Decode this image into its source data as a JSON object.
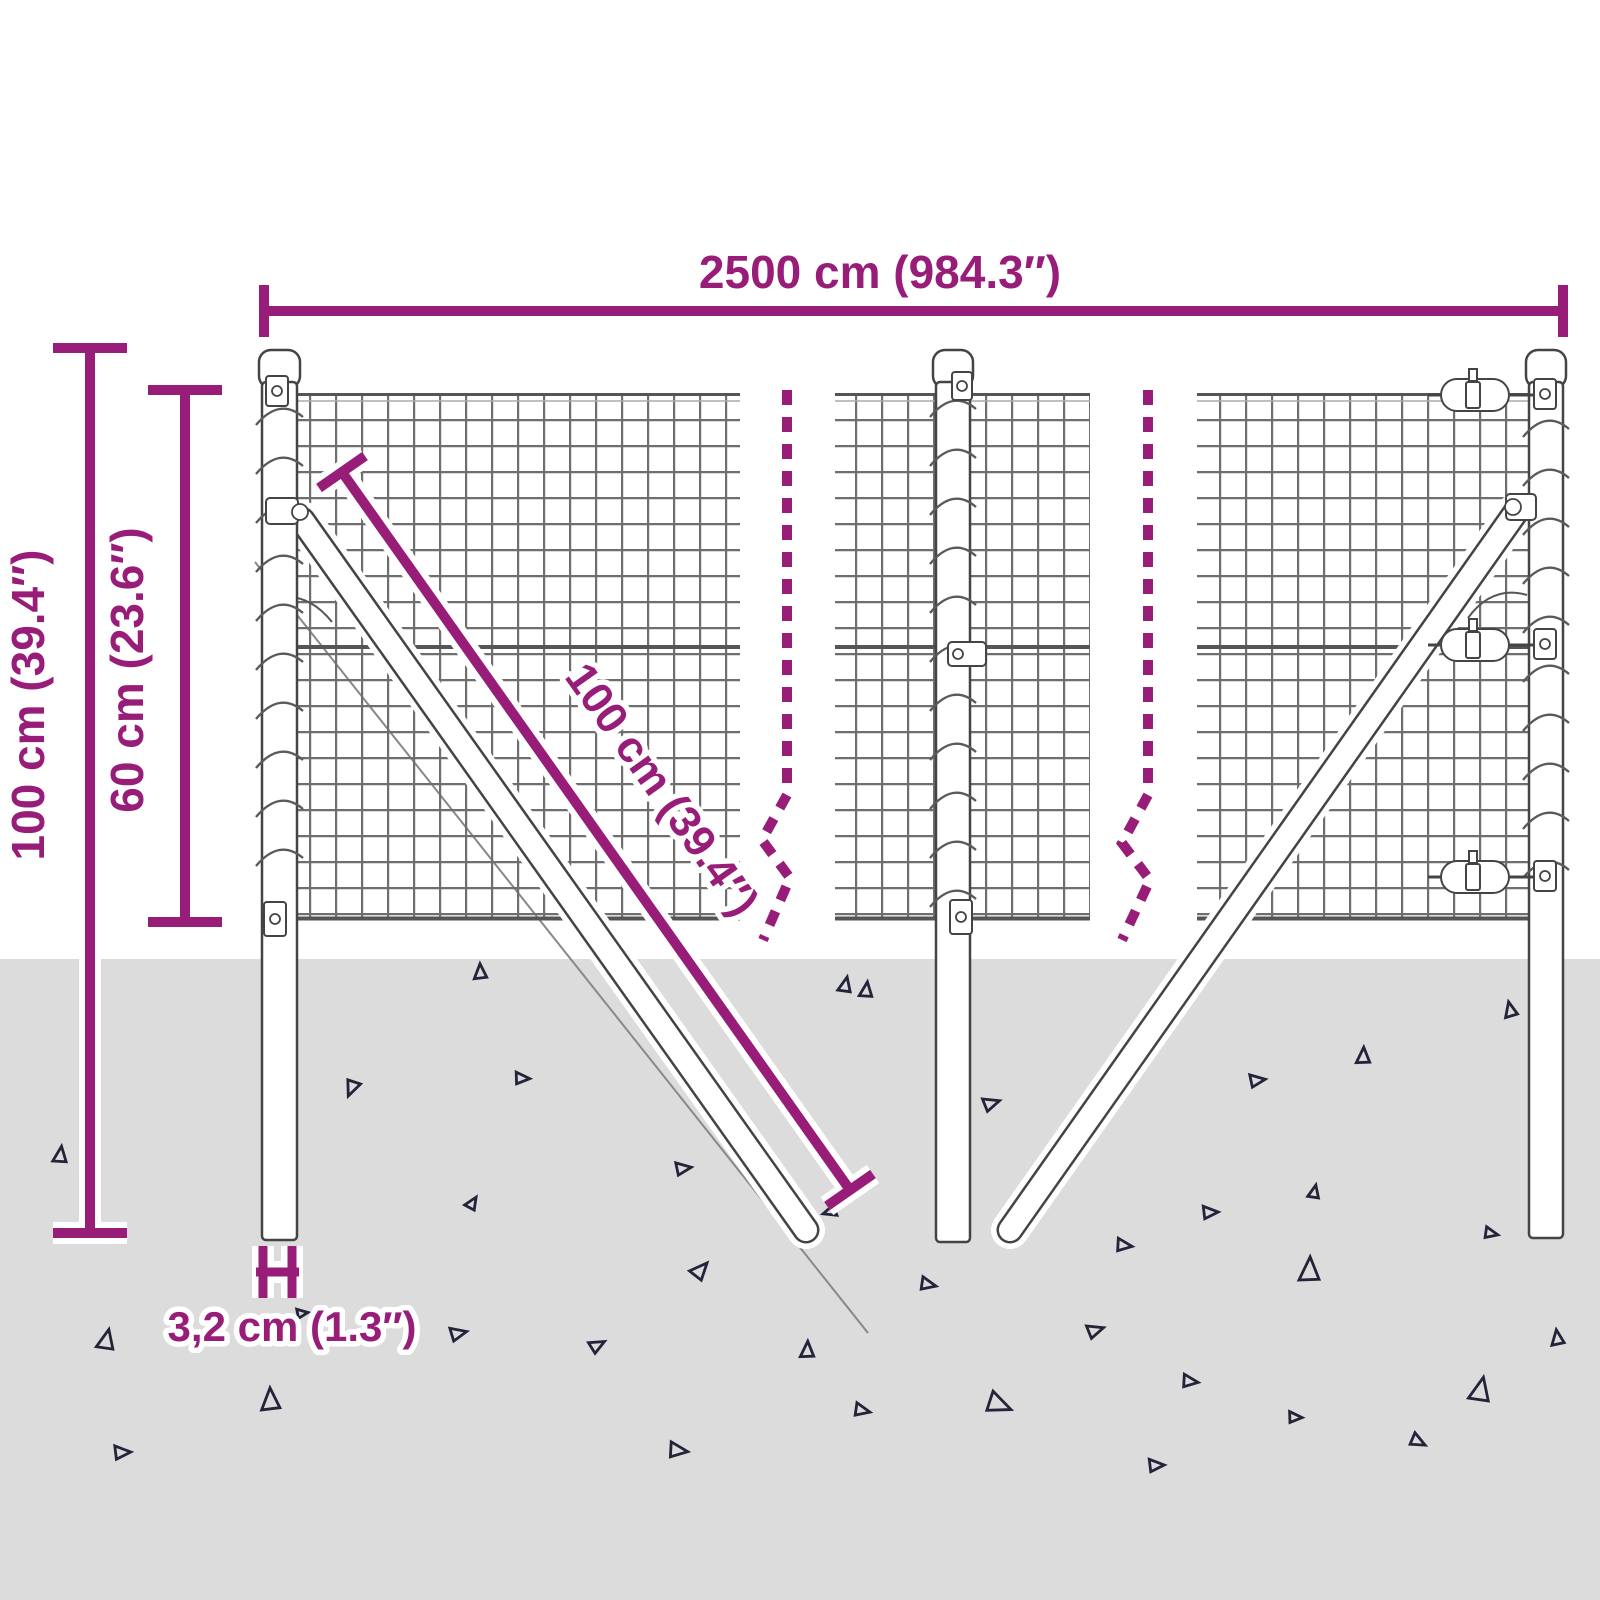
{
  "diagram": {
    "name": "wire-mesh-fence-dimension-diagram"
  },
  "labels": {
    "total_width": "2500 cm (984.3″)",
    "post_height": "100 cm (39.4″)",
    "mesh_height": "60 cm (23.6″)",
    "brace_length": "100 cm (39.4″)",
    "post_diameter": "3,2 cm (1.3″)"
  },
  "colors": {
    "accent": "#981d78",
    "ground": "#dcdcdc",
    "mesh_line": "#6e6e6e",
    "outline": "#444444",
    "triangle": "#23233a",
    "wire": "#555555"
  },
  "ground": {
    "triangles": [
      {
        "x": 480,
        "y": 972,
        "s": 15,
        "r": 0
      },
      {
        "x": 845,
        "y": 985,
        "s": 15,
        "r": 15
      },
      {
        "x": 352,
        "y": 1088,
        "s": 16,
        "r": 205
      },
      {
        "x": 522,
        "y": 1078,
        "s": 14,
        "r": 95
      },
      {
        "x": 60,
        "y": 1155,
        "s": 16,
        "r": 10
      },
      {
        "x": 683,
        "y": 1168,
        "s": 15,
        "r": 85
      },
      {
        "x": 472,
        "y": 1203,
        "s": 13,
        "r": 35
      },
      {
        "x": 700,
        "y": 1270,
        "s": 18,
        "r": 45
      },
      {
        "x": 991,
        "y": 1103,
        "s": 16,
        "r": 75
      },
      {
        "x": 1363,
        "y": 1056,
        "s": 16,
        "r": 5
      },
      {
        "x": 1257,
        "y": 1080,
        "s": 15,
        "r": 85
      },
      {
        "x": 1510,
        "y": 1010,
        "s": 15,
        "r": 350
      },
      {
        "x": 866,
        "y": 990,
        "s": 15,
        "r": 10
      },
      {
        "x": 1314,
        "y": 1192,
        "s": 13,
        "r": 15
      },
      {
        "x": 1210,
        "y": 1212,
        "s": 15,
        "r": 90
      },
      {
        "x": 1491,
        "y": 1233,
        "s": 13,
        "r": 105
      },
      {
        "x": 1124,
        "y": 1245,
        "s": 15,
        "r": 100
      },
      {
        "x": 1309,
        "y": 1270,
        "s": 24,
        "r": 5
      },
      {
        "x": 928,
        "y": 1284,
        "s": 15,
        "r": 105
      },
      {
        "x": 1557,
        "y": 1338,
        "s": 15,
        "r": 355
      },
      {
        "x": 1095,
        "y": 1330,
        "s": 16,
        "r": 75
      },
      {
        "x": 807,
        "y": 1350,
        "s": 16,
        "r": 5
      },
      {
        "x": 1190,
        "y": 1381,
        "s": 15,
        "r": 100
      },
      {
        "x": 1480,
        "y": 1390,
        "s": 24,
        "r": 15
      },
      {
        "x": 999,
        "y": 1404,
        "s": 24,
        "r": 115
      },
      {
        "x": 862,
        "y": 1410,
        "s": 15,
        "r": 105
      },
      {
        "x": 1295,
        "y": 1417,
        "s": 13,
        "r": 95
      },
      {
        "x": 1418,
        "y": 1441,
        "s": 15,
        "r": 120
      },
      {
        "x": 1156,
        "y": 1465,
        "s": 15,
        "r": 90
      },
      {
        "x": 106,
        "y": 1340,
        "s": 20,
        "r": 15
      },
      {
        "x": 458,
        "y": 1333,
        "s": 16,
        "r": 80
      },
      {
        "x": 597,
        "y": 1345,
        "s": 15,
        "r": 65
      },
      {
        "x": 270,
        "y": 1400,
        "s": 22,
        "r": 0
      },
      {
        "x": 122,
        "y": 1452,
        "s": 16,
        "r": 90
      },
      {
        "x": 678,
        "y": 1450,
        "s": 18,
        "r": 100
      },
      {
        "x": 830,
        "y": 1212,
        "s": 13,
        "r": 255
      },
      {
        "x": 302,
        "y": 1313,
        "s": 11,
        "r": 85
      }
    ]
  }
}
